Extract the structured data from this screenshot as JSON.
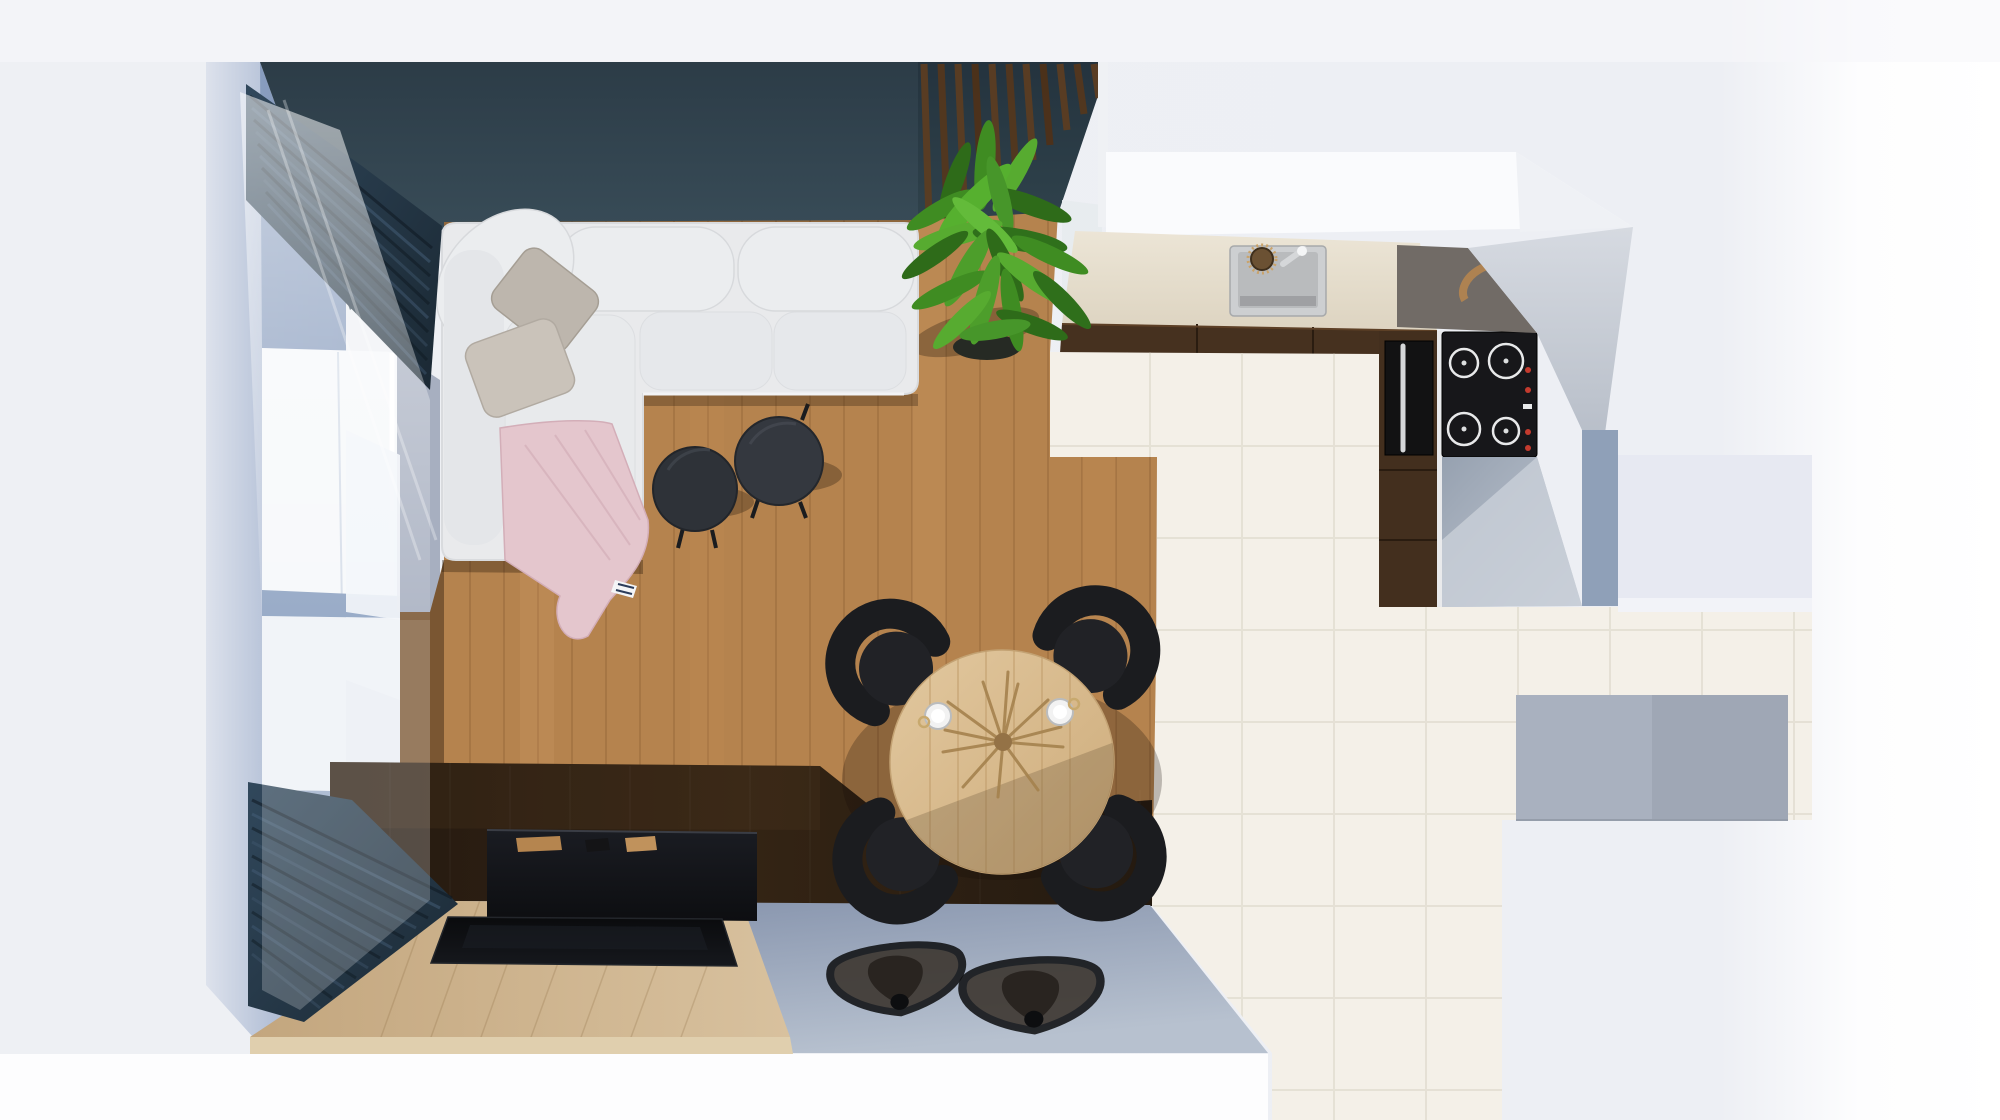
{
  "meta": {
    "type": "3d-floor-plan-render",
    "view": "top-down",
    "rooms_visible": [
      "living-room",
      "dining-area",
      "kitchen",
      "adjacent-room"
    ]
  },
  "palette": {
    "background": "#edeff4",
    "background_white": "#fdfdfe",
    "wall_teal": "#36474f",
    "divider_teal": "#2b3b47",
    "slat_wood": "#5b3d22",
    "curtain_navy": "#24394a",
    "left_wall_blue": "#9dafcc",
    "window_white": "#f6f8fa",
    "wood_floor": "#b5834e",
    "dark_floor": "#2b1e13",
    "tv_bench": "#121318",
    "tv_screen": "#0b0c0f",
    "oak_platform": "#cfb58e",
    "platform_edge": "#e0cfae",
    "blue_gray_floor": "#8d9bb3",
    "tile_floor": "#f4f0e8",
    "tile_seam": "#e4dfd3",
    "counter_beige": "#e5ded0",
    "cabinet_walnut": "#46311f",
    "cooktop_black": "#17171a",
    "oven_black": "#121213",
    "appliance_silver": "#d5d7d9",
    "sink_steel": "#cdcfd1",
    "burner_ring": "#e8e9ea",
    "control_red": "#c43b2e",
    "taupe_wall": "#716b66",
    "kitchen_wall": "#fafbfd",
    "wood_bowl": "#b5854f",
    "sofa_white": "#e9eaec",
    "sofa_cushion": "#ebedef",
    "pillow_gray": "#bdb6ad",
    "pillow_gray2": "#cac3ba",
    "blanket_pink": "#e4c6cd",
    "coffee_table_dark": "#2e3238",
    "coffee_table_dark2": "#34383f",
    "dining_table_oak": "#d9bd92",
    "chair_black": "#1b1c1f",
    "chair_seat": "#212226",
    "mat_black": "#17181b",
    "mat_fill": "#3a332c",
    "plant_green": "#3f8c22",
    "plant_green_dark": "#2e6b19",
    "plant_green_light": "#57ab30",
    "plant_pot": "#262a24",
    "pampas_tan": "#a5824e",
    "gray_rug": "#a9b1bf",
    "adjacent_room": "#e7e9f2",
    "cup_white": "#f2f2f2"
  },
  "scene": {
    "living_room": {
      "wall_finish": "dark teal",
      "floor_finish": "oak plank",
      "furniture": [
        {
          "name": "corner-sofa",
          "color": "#e9eaec"
        },
        {
          "name": "scatter-pillows",
          "count": 2,
          "color": "#bdb6ad"
        },
        {
          "name": "throw-blanket",
          "color": "#e4c6cd"
        },
        {
          "name": "coffee-table-pair",
          "count": 2,
          "color": "#2e3238"
        },
        {
          "name": "tv-screen",
          "color": "#0b0c0f"
        },
        {
          "name": "tv-bench",
          "color": "#121318"
        },
        {
          "name": "oak-floor-platform",
          "color": "#cfb58e"
        },
        {
          "name": "potted-plant",
          "color": "#3f8c22"
        },
        {
          "name": "slatted-room-divider",
          "color": "#5b3d22"
        },
        {
          "name": "navy-curtains",
          "count": 2,
          "color": "#24394a"
        },
        {
          "name": "windows",
          "count": 2,
          "color": "#f6f8fa"
        }
      ]
    },
    "dining_area": {
      "floor_finish": "dark walnut",
      "furniture": [
        {
          "name": "round-dining-table",
          "color": "#d9bd92"
        },
        {
          "name": "dining-chairs",
          "count": 4,
          "color": "#1b1c1f"
        },
        {
          "name": "dried-pampas-centerpiece",
          "color": "#a5824e"
        },
        {
          "name": "coffee-cups",
          "count": 2,
          "color": "#f2f2f2"
        },
        {
          "name": "fan-floor-mats",
          "count": 2,
          "color": "#17181b"
        }
      ]
    },
    "kitchen": {
      "floor_finish": "cream tile",
      "furniture": [
        {
          "name": "countertop",
          "color": "#e5ded0"
        },
        {
          "name": "sink",
          "color": "#cdcfd1"
        },
        {
          "name": "faucet",
          "color": "#d5d7d9"
        },
        {
          "name": "induction-cooktop",
          "burners": 4,
          "color": "#17171a"
        },
        {
          "name": "built-in-oven",
          "color": "#121213"
        },
        {
          "name": "walnut-cabinets",
          "color": "#46311f"
        }
      ]
    },
    "adjacent_room": {
      "items": [
        {
          "name": "gray-rug",
          "color": "#a9b1bf"
        }
      ]
    }
  }
}
